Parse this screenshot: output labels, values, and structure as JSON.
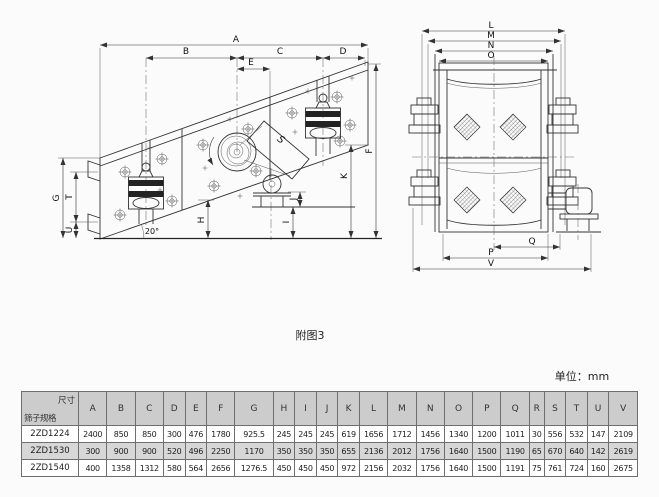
{
  "figure": {
    "caption": "附图3",
    "unit_label": "单位：mm"
  },
  "side_view": {
    "labels": {
      "a": "A",
      "b": "B",
      "c": "C",
      "d": "D",
      "e": "E",
      "f": "F",
      "g": "G",
      "h": "H",
      "i": "I",
      "j": "J",
      "k": "K",
      "s": "S",
      "t": "T",
      "u": "U"
    },
    "angle": "20°"
  },
  "front_view": {
    "labels": {
      "l": "L",
      "m": "M",
      "n": "N",
      "o": "O",
      "p": "P",
      "q": "Q",
      "v": "V"
    }
  },
  "table": {
    "corner_top": "尺寸",
    "corner_bottom": "筛子规格",
    "columns": [
      "A",
      "B",
      "C",
      "D",
      "E",
      "F",
      "G",
      "H",
      "I",
      "J",
      "K",
      "L",
      "M",
      "N",
      "O",
      "P",
      "Q",
      "R",
      "S",
      "T",
      "U",
      "V"
    ],
    "rows": [
      {
        "model": "2ZD1224",
        "values": [
          "2400",
          "850",
          "850",
          "300",
          "476",
          "1780",
          "925.5",
          "245",
          "245",
          "245",
          "619",
          "1656",
          "1712",
          "1456",
          "1340",
          "1200",
          "1011",
          "30",
          "556",
          "532",
          "147",
          "2109"
        ]
      },
      {
        "model": "2ZD1530",
        "values": [
          "300",
          "900",
          "900",
          "520",
          "496",
          "2250",
          "1170",
          "350",
          "350",
          "350",
          "655",
          "2136",
          "2012",
          "1756",
          "1640",
          "1500",
          "1190",
          "65",
          "670",
          "640",
          "142",
          "2619"
        ]
      },
      {
        "model": "2ZD1540",
        "values": [
          "400",
          "1358",
          "1312",
          "580",
          "564",
          "2656",
          "1276.5",
          "450",
          "450",
          "450",
          "972",
          "2156",
          "2032",
          "1756",
          "1640",
          "1500",
          "1191",
          "75",
          "761",
          "724",
          "160",
          "2675"
        ]
      }
    ]
  }
}
